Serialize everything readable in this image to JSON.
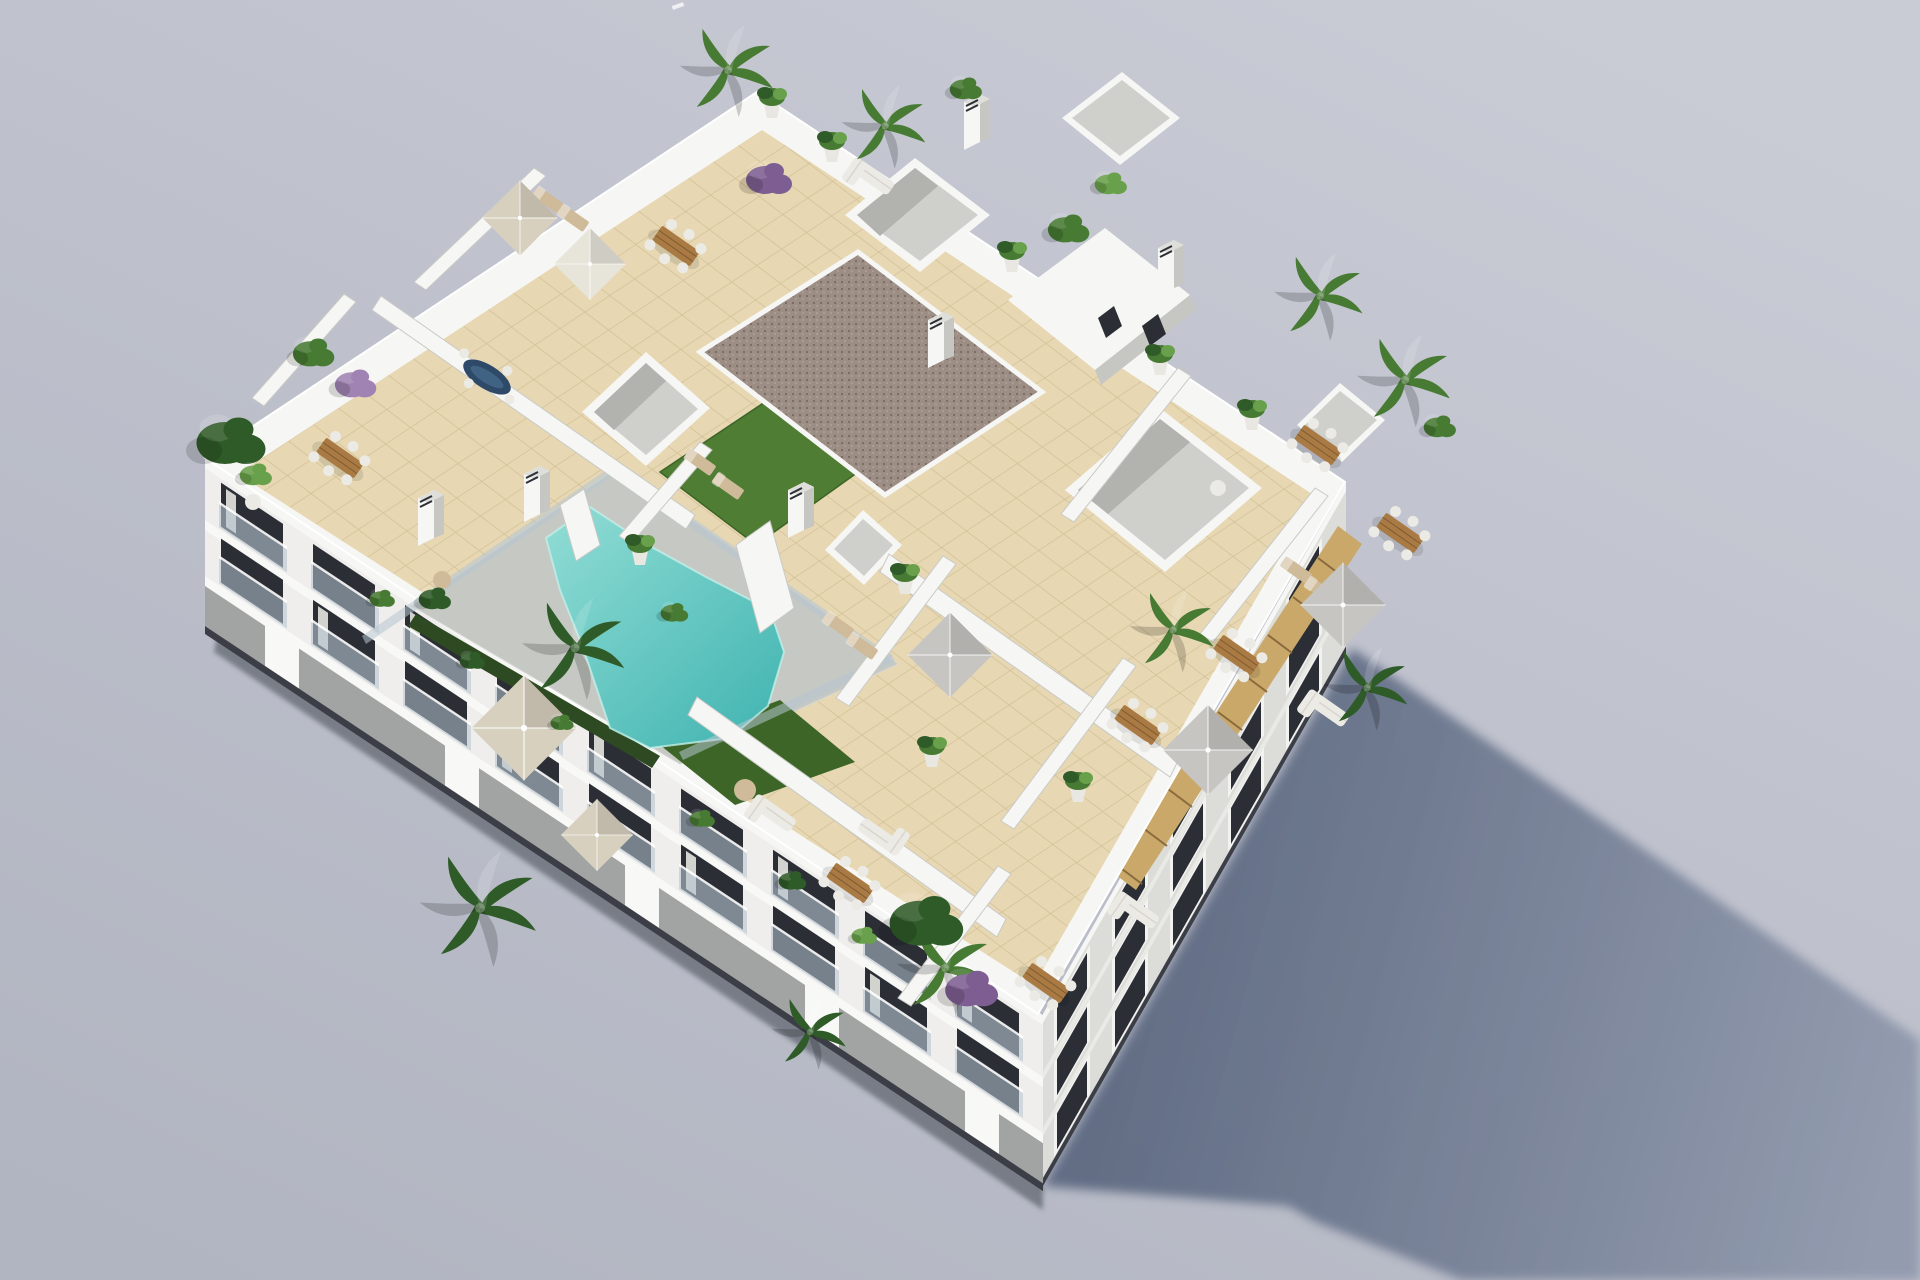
{
  "image": {
    "type": "3d-architectural-render",
    "subject": "aerial isometric render of a white apartment block with rooftop terraces and swimming pool",
    "width_px": 1920,
    "height_px": 1280
  },
  "colors": {
    "sky_top": "#c9cbd5",
    "sky_bottom": "#b1b5c1",
    "speck": "#eef0f4",
    "shadow_near": "#5c6880",
    "shadow_far": "#9099ad",
    "ground_shade": "#2c303a",
    "building_white": "#f6f6f4",
    "rim_shade": "#dededa",
    "wall_shade": "#c6c6c2",
    "inner_pit": "#cfcfcb",
    "inner_pit_dark": "#b2b2ae",
    "facade_left": "#efeeec",
    "facade_left_pier": "#f8f8f6",
    "facade_left_dark": "#a2a4a3",
    "facade_base_dark": "#3b3e46",
    "facade_right": "#dcdcd8",
    "facade_right_pier": "#e9e9e5",
    "window_dark": "#2b2e35",
    "window_frame": "#f2f2f0",
    "glass": "#b7c7d2",
    "curtain": "#f0efe9",
    "tile": "#e7d8b3",
    "tile_line": "#d2c096",
    "concrete": "#c5c8c3",
    "pool_shallow": "#8fdcd4",
    "pool_deep": "#3fb3b0",
    "pool_edge": "#c2efe9",
    "grass": "#4e7d33",
    "grass_dark": "#3c6527",
    "hedge": "#2d4a22",
    "gravel": "#9c8e85",
    "gravel_dot": "#786b62",
    "gravel_dot2": "#b3a79c",
    "wood": "#a97a43",
    "wood_dark": "#7e5a2f",
    "pergola": "#c9a86a",
    "pergola_line": "#8a6a3c",
    "furniture_white": "#eceae5",
    "furniture_tan": "#cfbb9a",
    "parasol_beige": "#d7d0bf",
    "parasol_white": "#e7e4da",
    "parasol_gray": "#c6c5c1",
    "leaf_dark": "#2f5b28",
    "leaf_mid": "#477a33",
    "leaf_light": "#69a04b",
    "purple": "#7e5e92",
    "purple_light": "#a083b2",
    "pot_white": "#e9e7e2",
    "table_navy": "#2e4a68"
  },
  "inventory": {
    "swimming_pool": 1,
    "parasols": 7,
    "dining_tables": 9,
    "outdoor_sofas": 5,
    "sun_loungers": 8,
    "roof_skylights": 6,
    "chimneys": 6,
    "plants_approx": 28,
    "building_floors_visible": 3
  }
}
